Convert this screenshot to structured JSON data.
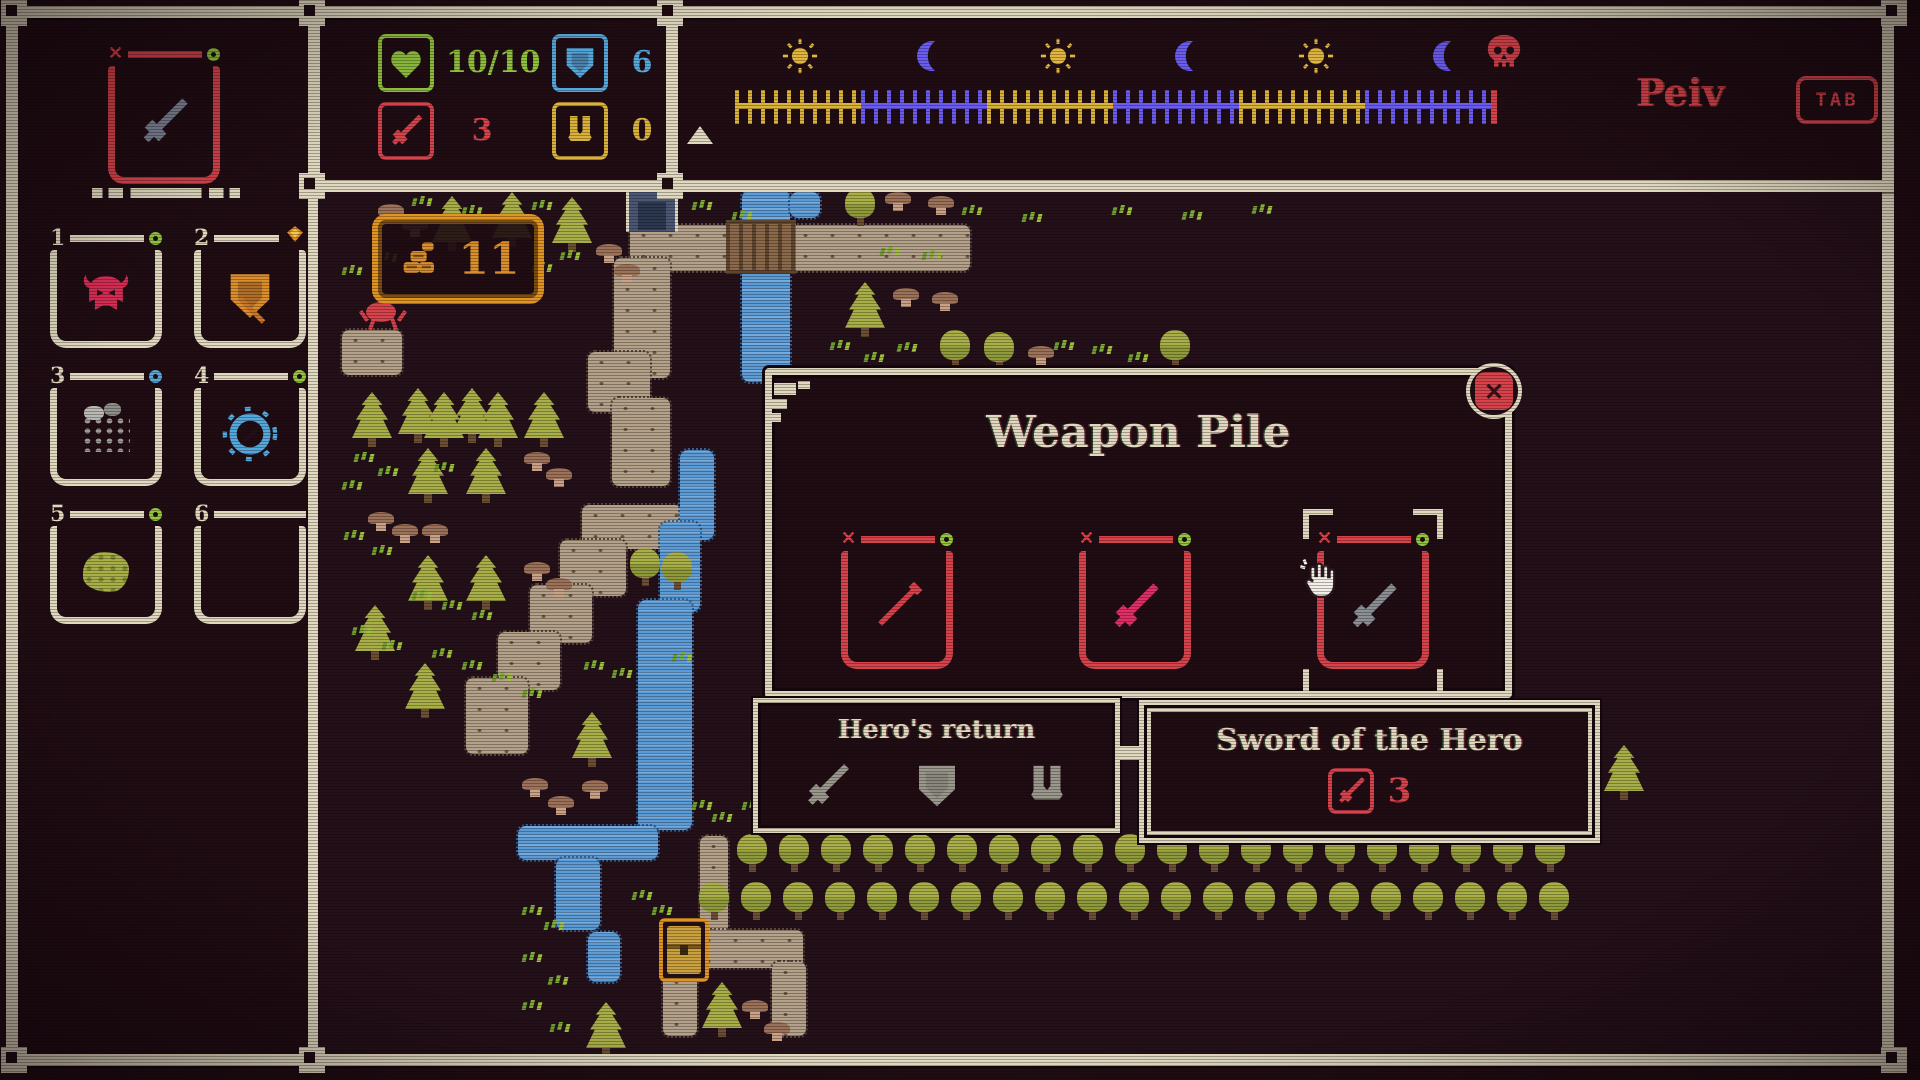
{
  "colors": {
    "bg": "#1f0d13",
    "cream": "#e0d9bf",
    "red": "#d7434b",
    "pink": "#de2f66",
    "green": "#93c83e",
    "blue": "#55a8dc",
    "gold": "#e09422",
    "yellow": "#d9b23c",
    "purple": "#6b5cf0",
    "olive": "#a9af47",
    "tan": "#b3a189",
    "water": "#5b9bd6",
    "steel": "#7e8696",
    "gray": "#9a988c"
  },
  "hud": {
    "equipped": {
      "mark": "✕",
      "item": "sword",
      "item_color": "#7e8696",
      "indicator": "ring-green"
    },
    "hotbar": [
      {
        "number": "1",
        "item": "helmet",
        "item_color": "#d92d55",
        "indicator": "ring-green"
      },
      {
        "number": "2",
        "item": "shield",
        "item_color": "#dc8e2a",
        "indicator": "gem"
      },
      {
        "number": "3",
        "item": "net",
        "item_color": "#9c9c94",
        "indicator": "ring-blue"
      },
      {
        "number": "4",
        "item": "compass",
        "item_color": "#55a8dc",
        "indicator": "ring-green"
      },
      {
        "number": "5",
        "item": "moss",
        "item_color": "#a9af47",
        "indicator": "ring-green"
      },
      {
        "number": "6",
        "item": "",
        "item_color": "",
        "indicator": ""
      }
    ],
    "stats": [
      {
        "icon": "heart",
        "value": "10/10",
        "color": "#93c83e"
      },
      {
        "icon": "shield",
        "value": "6",
        "color": "#55a8dc"
      },
      {
        "icon": "sword",
        "value": "3",
        "color": "#d7434b"
      },
      {
        "icon": "boots",
        "value": "0",
        "color": "#d9b23c"
      }
    ],
    "timeline": {
      "phases": [
        "sun",
        "moon",
        "sun",
        "moon",
        "sun",
        "moon"
      ],
      "end_icon": "skull",
      "icon_x": [
        800,
        929,
        1058,
        1187,
        1316,
        1445
      ],
      "bar": [
        735,
        1491
      ],
      "marker_x": 700
    },
    "player_name": "Peiv",
    "tab_label": "TAB"
  },
  "map": {
    "gold_count": "11",
    "paths": [
      [
        630,
        225,
        340,
        46
      ],
      [
        614,
        258,
        56,
        120
      ],
      [
        588,
        352,
        62,
        60
      ],
      [
        612,
        398,
        58,
        88
      ],
      [
        582,
        505,
        100,
        44
      ],
      [
        560,
        540,
        66,
        56
      ],
      [
        530,
        585,
        62,
        58
      ],
      [
        498,
        632,
        62,
        58
      ],
      [
        466,
        678,
        62,
        76
      ],
      [
        700,
        836,
        28,
        102
      ],
      [
        695,
        930,
        108,
        38
      ],
      [
        772,
        962,
        34,
        74
      ],
      [
        663,
        972,
        34,
        64
      ],
      [
        342,
        330,
        60,
        45
      ]
    ],
    "rivers": [
      [
        742,
        190,
        48,
        192
      ],
      [
        790,
        192,
        30,
        26
      ],
      [
        680,
        450,
        34,
        90
      ],
      [
        660,
        522,
        40,
        90
      ],
      [
        638,
        600,
        54,
        230
      ],
      [
        518,
        826,
        140,
        34
      ],
      [
        556,
        858,
        44,
        72
      ],
      [
        588,
        932,
        32,
        50
      ]
    ],
    "tree_rows": [
      {
        "y": 834,
        "x0": 737,
        "x1": 1570,
        "step": 42
      },
      {
        "y": 882,
        "x0": 699,
        "x1": 1580,
        "step": 42
      }
    ],
    "pines": [
      [
        352,
        392
      ],
      [
        398,
        388
      ],
      [
        424,
        392
      ],
      [
        452,
        388
      ],
      [
        478,
        392
      ],
      [
        524,
        392
      ],
      [
        408,
        448
      ],
      [
        466,
        448
      ],
      [
        408,
        555
      ],
      [
        466,
        555
      ],
      [
        355,
        605
      ],
      [
        405,
        663
      ],
      [
        572,
        712
      ],
      [
        586,
        1002
      ],
      [
        702,
        982
      ],
      [
        845,
        282
      ],
      [
        432,
        196
      ],
      [
        492,
        192
      ],
      [
        552,
        197
      ],
      [
        1604,
        745
      ]
    ],
    "round_trees": [
      [
        630,
        548
      ],
      [
        662,
        552
      ],
      [
        940,
        330
      ],
      [
        984,
        332
      ],
      [
        1160,
        330
      ],
      [
        845,
        188
      ]
    ],
    "grass": [
      [
        888,
        246
      ],
      [
        930,
        250
      ],
      [
        1062,
        340
      ],
      [
        1100,
        344
      ],
      [
        1136,
        352
      ],
      [
        838,
        340
      ],
      [
        872,
        352
      ],
      [
        905,
        342
      ],
      [
        700,
        200
      ],
      [
        740,
        210
      ],
      [
        540,
        200
      ],
      [
        470,
        205
      ],
      [
        420,
        196
      ],
      [
        385,
        252
      ],
      [
        350,
        265
      ],
      [
        568,
        250
      ],
      [
        540,
        262
      ],
      [
        362,
        452
      ],
      [
        386,
        466
      ],
      [
        350,
        480
      ],
      [
        442,
        462
      ],
      [
        352,
        530
      ],
      [
        380,
        545
      ],
      [
        420,
        590
      ],
      [
        450,
        600
      ],
      [
        480,
        610
      ],
      [
        360,
        625
      ],
      [
        390,
        640
      ],
      [
        440,
        648
      ],
      [
        470,
        660
      ],
      [
        500,
        672
      ],
      [
        530,
        688
      ],
      [
        592,
        660
      ],
      [
        620,
        668
      ],
      [
        680,
        652
      ],
      [
        700,
        800
      ],
      [
        720,
        812
      ],
      [
        750,
        800
      ],
      [
        530,
        905
      ],
      [
        552,
        920
      ],
      [
        530,
        952
      ],
      [
        556,
        975
      ],
      [
        530,
        1000
      ],
      [
        558,
        1022
      ],
      [
        640,
        890
      ],
      [
        660,
        905
      ],
      [
        1120,
        205
      ],
      [
        1190,
        210
      ],
      [
        1260,
        204
      ],
      [
        970,
        205
      ],
      [
        1030,
        212
      ]
    ],
    "mushrooms": [
      [
        596,
        244
      ],
      [
        614,
        264
      ],
      [
        378,
        204
      ],
      [
        402,
        218
      ],
      [
        368,
        512
      ],
      [
        392,
        524
      ],
      [
        422,
        524
      ],
      [
        524,
        452
      ],
      [
        546,
        468
      ],
      [
        524,
        562
      ],
      [
        546,
        578
      ],
      [
        522,
        778
      ],
      [
        548,
        796
      ],
      [
        582,
        780
      ],
      [
        742,
        1000
      ],
      [
        764,
        1022
      ],
      [
        885,
        192
      ],
      [
        928,
        196
      ],
      [
        893,
        288
      ],
      [
        932,
        292
      ],
      [
        1028,
        346
      ]
    ],
    "structures": {
      "well": [
        626,
        188,
        52,
        44
      ],
      "bridge": [
        726,
        220,
        70,
        54
      ],
      "dock": [
        763,
        368,
        44,
        64
      ],
      "chest": [
        659,
        918,
        50,
        64
      ],
      "creature": [
        358,
        294,
        52,
        40
      ]
    }
  },
  "modal": {
    "title": "Weapon Pile",
    "close_label": "✕",
    "slots": [
      {
        "mark": "✕",
        "item": "spear",
        "item_color": "#d7434b",
        "selected": false
      },
      {
        "mark": "✕",
        "item": "sword",
        "item_color": "#de2f66",
        "selected": false
      },
      {
        "mark": "✕",
        "item": "sword",
        "item_color": "#8a9094",
        "selected": true
      }
    ]
  },
  "tooltips": {
    "set": {
      "title": "Hero's return",
      "icons": [
        "sword",
        "shield",
        "boots"
      ],
      "icon_color": "#9a988c"
    },
    "item": {
      "title": "Sword of the Hero",
      "stat": {
        "icon": "sword",
        "value": "3",
        "color": "#d7434b"
      }
    }
  }
}
